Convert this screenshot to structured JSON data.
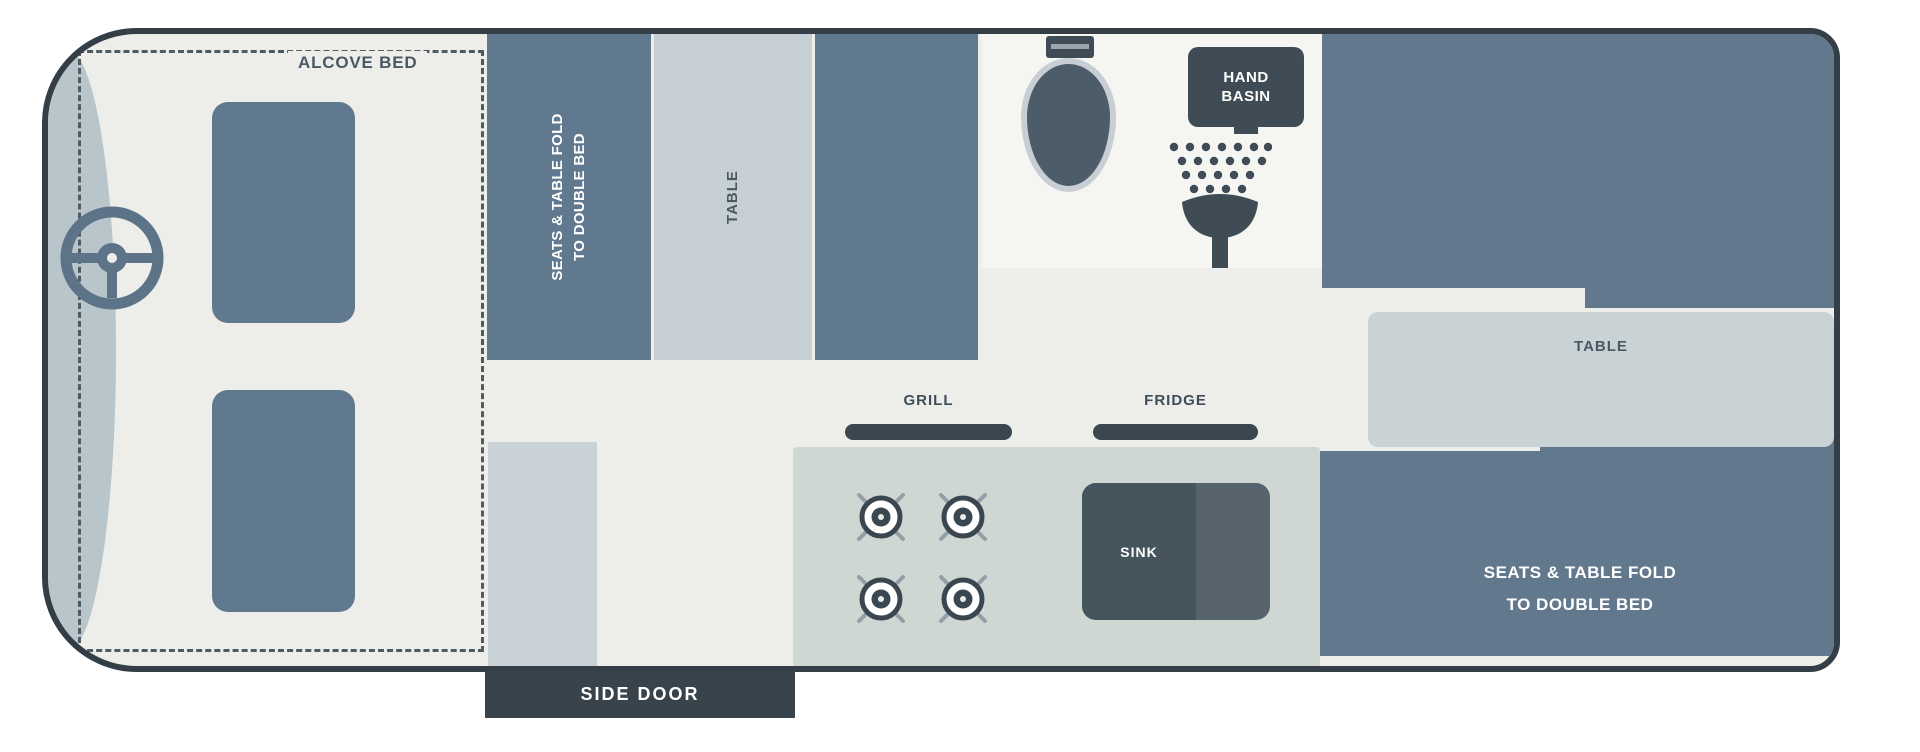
{
  "diagram_type": "campervan-floorplan",
  "colors": {
    "vehicle_outline": "#343e47",
    "floor": "#edeeea",
    "bathroom_floor": "#f5f6f2",
    "furniture_dark": "#61798e",
    "furniture_light": "#c6d0d4",
    "kitchen_counter": "#ced7d2",
    "fixture_dark": "#3f4c55",
    "cab_front": "#b8c5ca",
    "label_text": "#4a5866",
    "text_on_dark": "#ffffff"
  },
  "areas": {
    "alcove_bed": {
      "label": "ALCOVE BED"
    },
    "front_dinette": {
      "line1": "SEATS & TABLE FOLD",
      "line2": "TO DOUBLE BED"
    },
    "front_table": {
      "label": "TABLE"
    },
    "hand_basin": {
      "line1": "HAND",
      "line2": "BASIN"
    },
    "kitchen": {
      "grill_label": "GRILL",
      "fridge_label": "FRIDGE",
      "sink_label": "SINK"
    },
    "rear_table": {
      "label": "TABLE"
    },
    "rear_dinette": {
      "line1": "SEATS & TABLE FOLD",
      "line2": "TO DOUBLE BED"
    },
    "side_door": {
      "label": "SIDE DOOR"
    }
  },
  "icons": {
    "steering_wheel": "steering-wheel-icon",
    "toilet": "toilet-icon",
    "shower": "shower-icon",
    "hob": "hob-burners-icon"
  }
}
